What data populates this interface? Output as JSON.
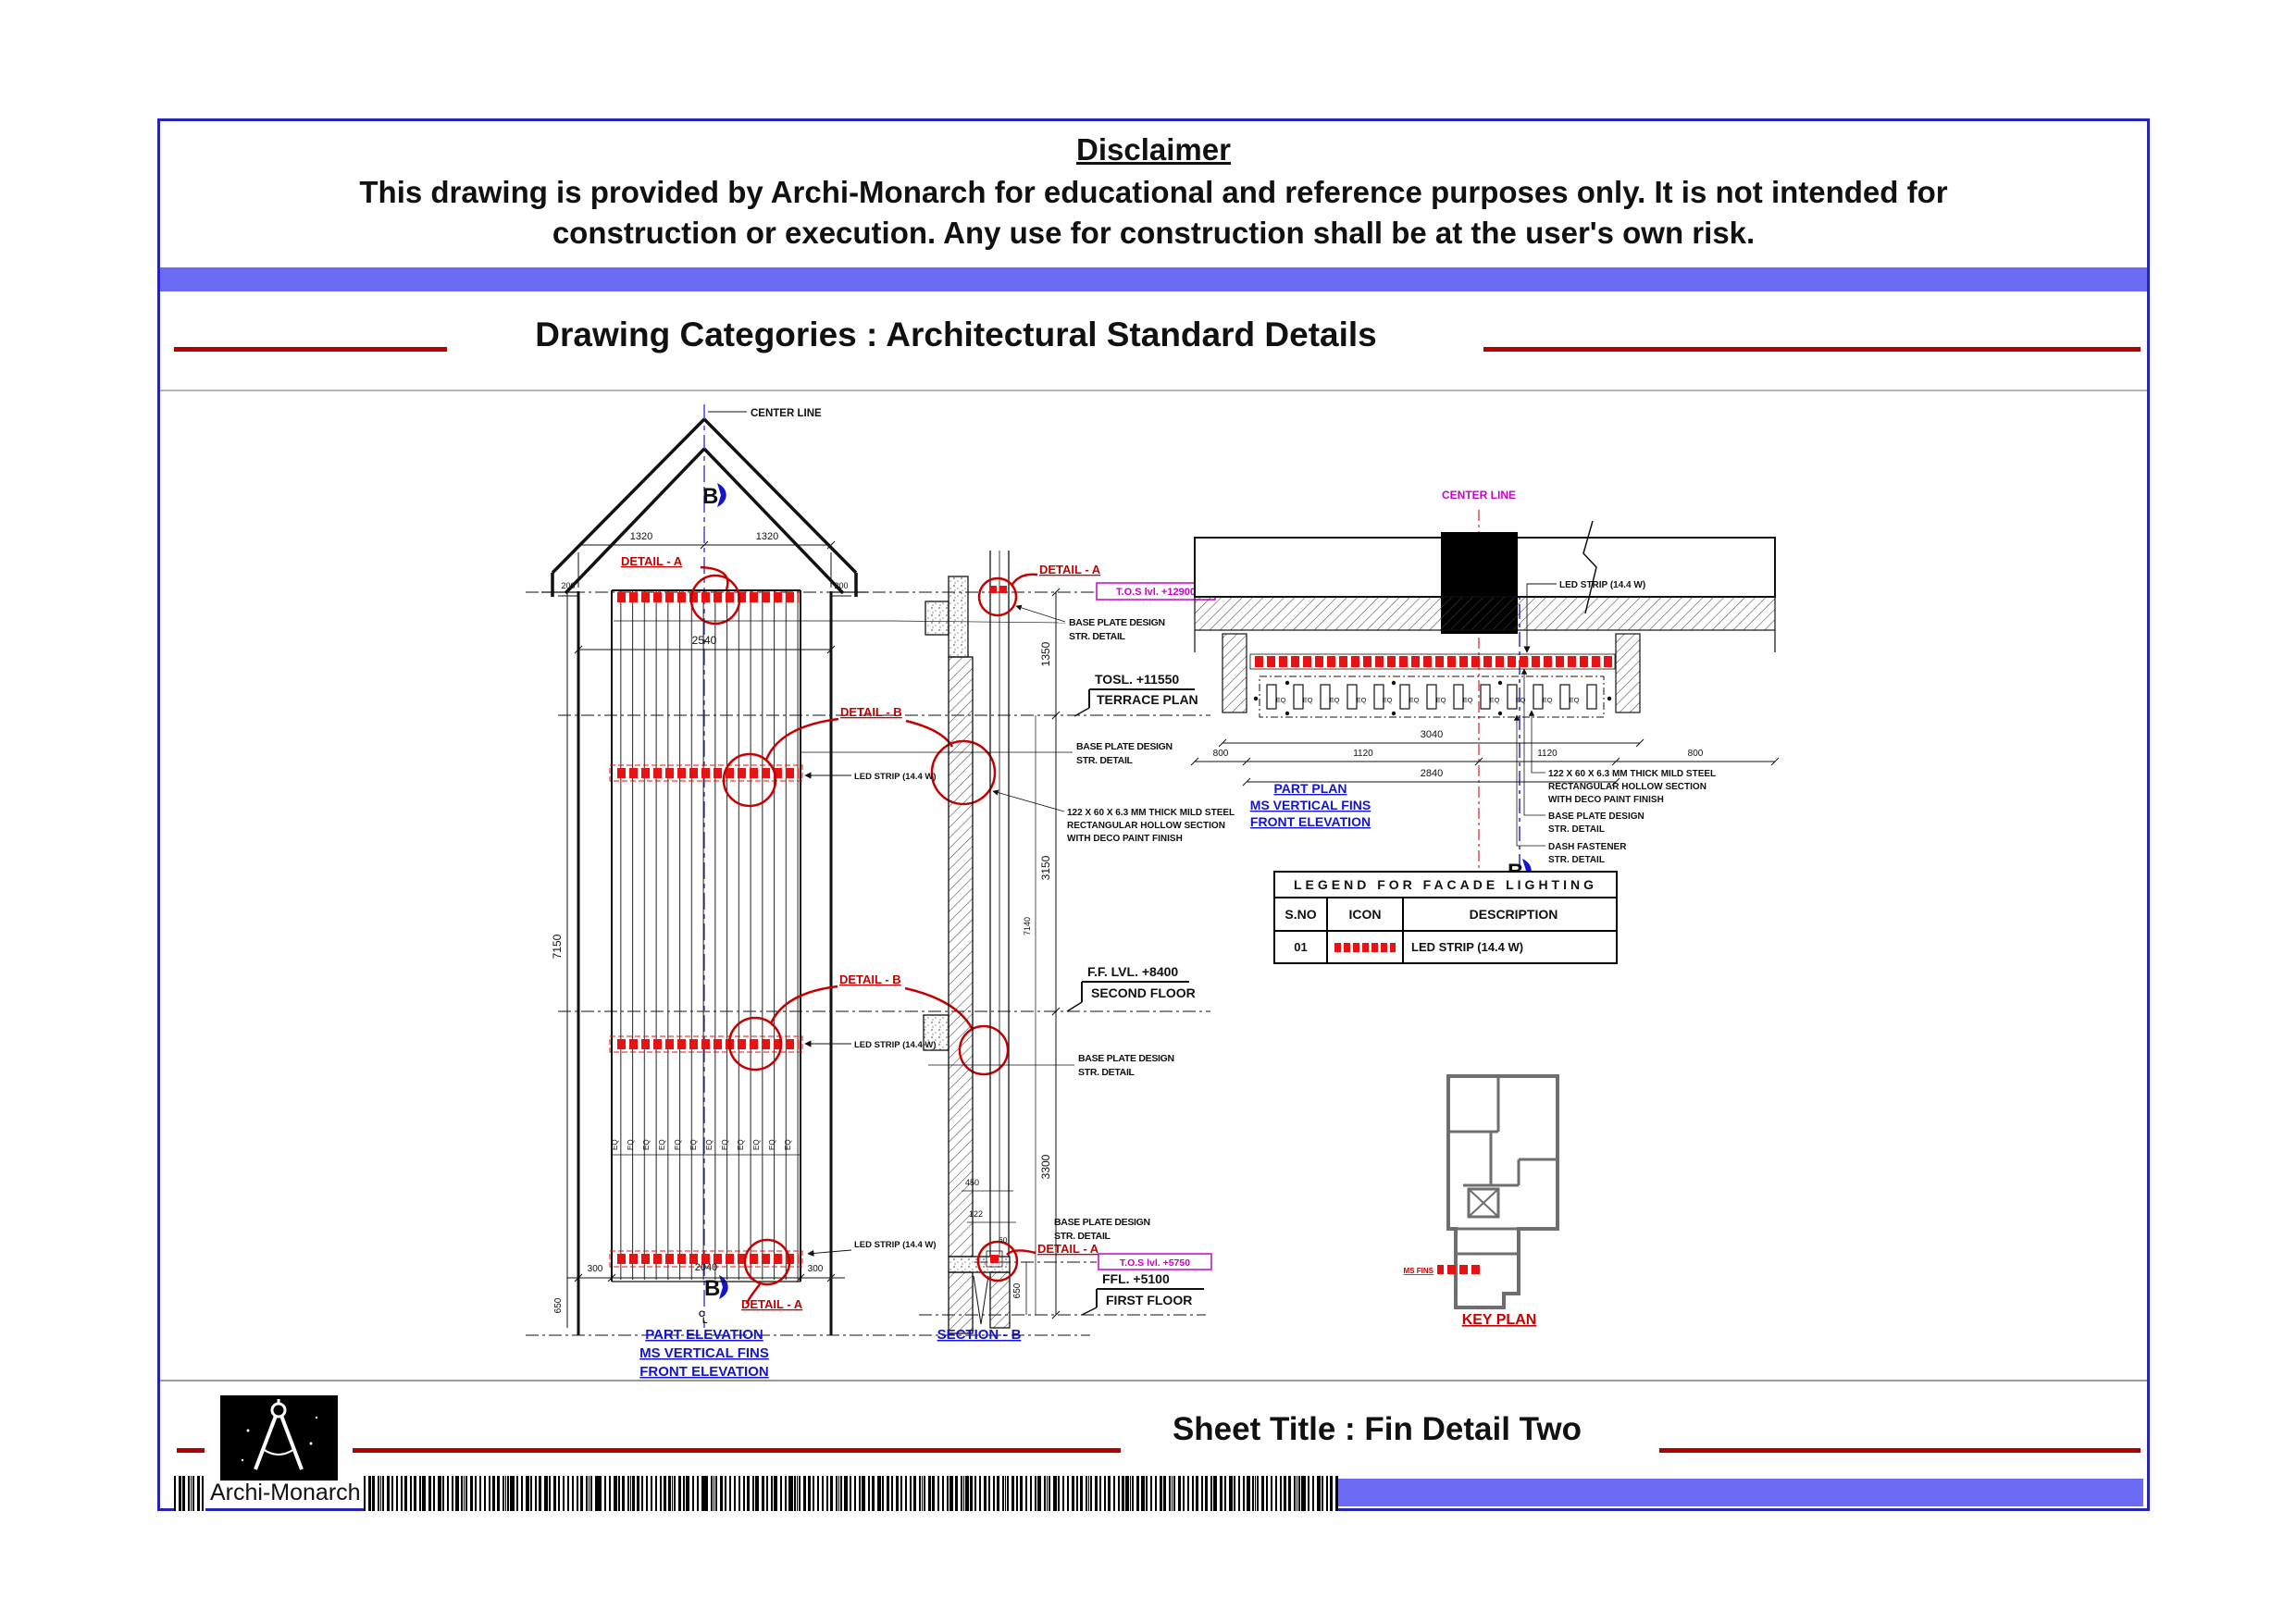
{
  "colors": {
    "frame_blue": "#2424b8",
    "bar_purple": "#6a6af2",
    "accent_red": "#b40000",
    "led_red": "#e81212",
    "detail_red": "#c40000",
    "magenta": "#cc00cc",
    "label_blue": "#1414cc",
    "wall_gray": "#6e6e6e"
  },
  "header": {
    "disclaimer_title": "Disclaimer",
    "disclaimer_line1": "This drawing is provided by Archi-Monarch for educational and reference purposes only. It is not intended for",
    "disclaimer_line2": "construction or execution. Any use for construction shall be at the user's own risk.",
    "category_label": "Drawing Categories : Architectural Standard Details"
  },
  "common": {
    "b": "B",
    "eq": "EQ",
    "cl_c": "C",
    "cl_l": "L",
    "center_line": "CENTER LINE",
    "detail_a": "DETAIL - A",
    "detail_b": "DETAIL - B",
    "led_strip": "LED STRIP (14.4 W)",
    "base_plate": "BASE PLATE DESIGN",
    "str_detail": "STR. DETAIL",
    "steel_1": "122 X 60 X 6.3 MM THICK MILD STEEL",
    "steel_2": "RECTANGULAR HOLLOW SECTION",
    "steel_3": "WITH DECO PAINT FINISH",
    "dash_fastener": "DASH FASTENER"
  },
  "elevation": {
    "dims": {
      "left_roof": "1320",
      "right_roof": "1320",
      "edge_left": "200",
      "edge_right": "200",
      "mid_width": "2540",
      "height": "7150",
      "bottom_left": "300",
      "bottom_mid": "2040",
      "bottom_right": "300",
      "base_height": "650"
    },
    "caption": {
      "l1": "PART ELEVATION",
      "l2": "MS VERTICAL FINS",
      "l3": "FRONT ELEVATION"
    }
  },
  "section": {
    "dims": {
      "d1350": "1350",
      "d3150": "3150",
      "d3300": "3300",
      "d650": "650",
      "d7140": "7140",
      "d450": "450",
      "d122": "122",
      "d60": "60"
    },
    "levels": {
      "tos_top": "T.O.S lvl. +12900",
      "tosl": "TOSL. +11550",
      "terrace": "TERRACE PLAN",
      "ff2": "F.F. LVL. +8400",
      "second": "SECOND FLOOR",
      "tos_bottom": "T.O.S lvl. +5750",
      "ffl": "FFL. +5100",
      "first": "FIRST FLOOR"
    },
    "caption": "SECTION - B"
  },
  "part_plan": {
    "dims": {
      "total_top": "3040",
      "edge_left": "800",
      "inner_left": "1120",
      "inner_right": "1120",
      "edge_right": "800",
      "total_bottom": "2840"
    },
    "caption": {
      "l1": "PART PLAN",
      "l2": "MS VERTICAL FINS",
      "l3": "FRONT ELEVATION"
    }
  },
  "legend": {
    "title": "LEGEND FOR FACADE LIGHTING",
    "col_sno": "S.NO",
    "col_icon": "ICON",
    "col_desc": "DESCRIPTION",
    "row_no": "01",
    "row_desc": "LED STRIP (14.4 W)"
  },
  "key_plan": {
    "label": "KEY PLAN",
    "fins_label": "MS FINS"
  },
  "footer": {
    "sheet_title": "Sheet Title : Fin Detail Two",
    "brand": "Archi-Monarch"
  }
}
